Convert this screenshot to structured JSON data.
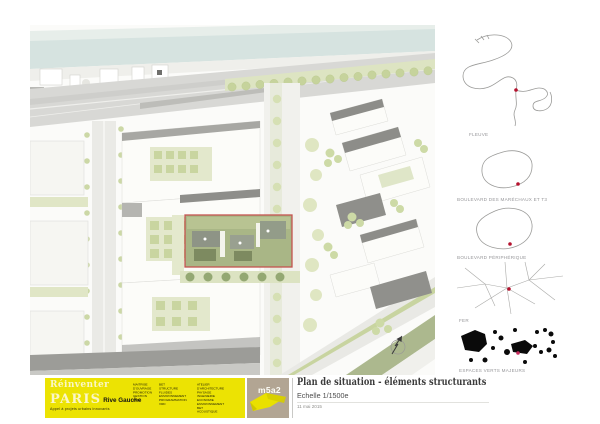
{
  "page": {
    "width": 600,
    "height": 424
  },
  "titleblock": {
    "title": "Plan de situation - éléments structurants",
    "scale": "Echelle 1/1500e",
    "date": "11 mai 2015"
  },
  "banner": {
    "brand_line1": "Réinventer",
    "brand_line2": "PARIS",
    "brand_line3": "Rive Gauche",
    "brand_sub": "Appel à projets urbains innovants",
    "credits_col1": [
      "MAITRISE",
      "D'OUVRAGE",
      "PROMOTION",
      "GESTION",
      "AMO"
    ],
    "credits_col2": [
      "BET",
      "STRUCTURE",
      "FLUIDES ENVIRONNEMENT",
      "PROGRAMMATION",
      "VRD"
    ],
    "credits_col3": [
      "ATELIER D'ARCHITECTURE",
      "PAYSAGE",
      "INGENIERIE",
      "ECONOMIE ENVIRONNEMENT",
      "BET ACOUSTIQUE"
    ],
    "lot_name": "m5a2",
    "yellow": "#ece303",
    "lot_bg": "#b2a593"
  },
  "legend": {
    "items": [
      {
        "label": "FLEUVE"
      },
      {
        "label": "BOULEVARD DES MARÉCHAUX ET T3"
      },
      {
        "label": "BOULEVARD PÉRIPHÉRIQUE"
      },
      {
        "label": "FER"
      },
      {
        "label": "ESPACES VERTS MAJEURS"
      }
    ],
    "marker_color": "#b5122e"
  },
  "map": {
    "description": "Plan de situation 1/1500e — Paris Rive Gauche, lot m5a2",
    "colors": {
      "water": "#d6e3e0",
      "road": "#d8d8d5",
      "building": "#fcfcf9",
      "shadow": "#8e8e8a",
      "green_light": "#dde4c2",
      "tree": "#c9d6a2",
      "olive": "#9dab7b",
      "site_outline": "#c4544e",
      "site_fill": "#a9b686"
    }
  }
}
